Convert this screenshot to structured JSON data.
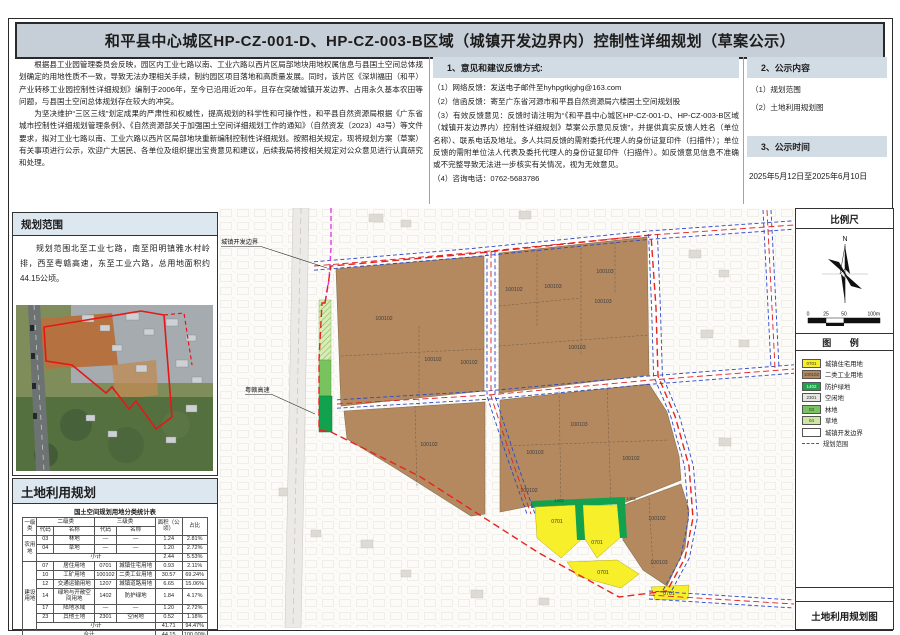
{
  "title": "和平县中心城区HP-CZ-001-D、HP-CZ-003-B区域（城镇开发边界内）控制性详细规划（草案公示）",
  "intro": {
    "p1": "根据县工业园管理委员会反映，园区内工业七路以南、工业六路以西片区局部地块用地权属信息与县国土空间总体规划确定的用地性质不一致，导致无法办理相关手续，制约园区项目落地和高质量发展。同时，该片区《深圳福田（和平）产业转移工业园控制性详细规划》编制于2006年，至今已沿用近20年，且存在突破城镇开发边界、占用永久基本农田等问题，与县国土空间总体规划存在较大的冲突。",
    "p2": "为坚决维护“三区三线”划定成果的严肃性和权威性，提高规划的科学性和可操作性，和平县自然资源局根据《广东省城市控制性详细规划管理条例》、《自然资源部关于加强国土空间详细规划工作的通知》（自然资发〔2023〕43号）等文件要求，拟对工业七路以南、工业六路以西片区局部地块重新编制控制性详细规划。按照相关规定，现将规划方案（草案）有关事项进行公示，欢迎广大居民、各单位及组织提出宝贵意见和建议，后续我局将按相关规定对公众意见进行认真研究和处理。"
  },
  "feedback": {
    "heading": "1、意见和建议反馈方式:",
    "item1": "（1）网络反馈：发送电子邮件至hyhpgtkjghg@163.com",
    "item2": "（2）信函反馈：寄至广东省河源市和平县自然资源局六楼国土空间规划股",
    "item3": "（3）有效反馈意见：反馈时请注明为“《和平县中心城区HP-CZ-001-D、HP-CZ-003-B区域（城镇开发边界内）控制性详细规划》草案公示意见反馈”，并提供真实反馈人姓名（单位名称）、联系电话及地址。多人共同反馈的需附委托代理人的身份证复印件（扫描件）；单位反馈的需附单位法人代表及委托代理人的身份证复印件（扫描件）。如反馈意见信息不准确或不完整导致无法进一步核实有关情况，视为无效意见。",
    "item4": "（4）咨询电话：0762-5683786"
  },
  "content_section": {
    "heading": "2、公示内容",
    "item1": "（1）规划范围",
    "item2": "（2）土地利用规划图"
  },
  "time_section": {
    "heading": "3、公示时间",
    "text": "2025年5月12日至2025年6月10日"
  },
  "scope_panel": {
    "heading": "规划范围",
    "text": "规划范围北至工业七路，南至阳明镇雅水村岭排，西至粤赣高速，东至工业六路，总用地面积约44.15公顷。"
  },
  "landuse_panel": {
    "heading": "土地利用规划",
    "table": {
      "title": "国土空间规划用地分类统计表",
      "headers": {
        "l1": "一级类",
        "l2": "二级类",
        "l3": "三级类",
        "code": "代码",
        "name": "名称",
        "area": "面积（公顷）",
        "pct": "占比"
      },
      "r1": {
        "cat": "农用地",
        "c2": "03",
        "n2": "林地",
        "c3": "—",
        "n3": "—",
        "area": "1.24",
        "pct": "2.81%"
      },
      "r2": {
        "c2": "04",
        "n2": "草地",
        "c3": "—",
        "n3": "—",
        "area": "1.20",
        "pct": "2.72%"
      },
      "r3": {
        "label": "小计",
        "area": "2.44",
        "pct": "5.53%"
      },
      "r4": {
        "cat": "建设用地",
        "c2": "07",
        "n2": "居住用地",
        "c3": "0701",
        "n3": "城镇住宅用地",
        "area": "0.93",
        "pct": "2.11%"
      },
      "r5": {
        "c2": "10",
        "n2": "工矿用地",
        "c3": "100102",
        "n3": "二类工业用地",
        "area": "30.57",
        "pct": "69.24%"
      },
      "r6": {
        "c2": "12",
        "n2": "交通运输用地",
        "c3": "1207",
        "n3": "城镇道路用地",
        "area": "6.65",
        "pct": "15.06%"
      },
      "r7": {
        "c2": "14",
        "n2": "绿地与开敞空间用地",
        "c3": "1402",
        "n3": "防护绿地",
        "area": "1.84",
        "pct": "4.17%"
      },
      "r8": {
        "c2": "17",
        "n2": "陆地水域",
        "c3": "—",
        "n3": "—",
        "area": "1.20",
        "pct": "2.72%"
      },
      "r9": {
        "c2": "23",
        "n2": "其他土地",
        "c3": "2301",
        "n3": "空闲地",
        "area": "0.52",
        "pct": "1.18%"
      },
      "r10": {
        "label": "小计",
        "area": "41.71",
        "pct": "94.47%"
      },
      "r11": {
        "label": "合计",
        "area": "44.15",
        "pct": "100.00%"
      }
    }
  },
  "map": {
    "annotations": {
      "boundary": "城镇开发边界",
      "highway": "粤赣高速"
    },
    "labels": [
      "100102",
      "100102",
      "100102",
      "100102",
      "100103",
      "100103",
      "100103",
      "100103",
      "100103",
      "100102",
      "100103",
      "100102",
      "100102",
      "100102",
      "100103",
      "0701",
      "0701",
      "0701",
      "0701",
      "1402",
      "1402"
    ]
  },
  "sidebar": {
    "scale_title": "比例尺",
    "north": "N",
    "scale_ticks": [
      "0",
      "25",
      "50",
      "100m"
    ],
    "legend_title": "图 例",
    "legend": [
      {
        "code": "0701",
        "label": "城镇住宅用地",
        "color": "#f7ef2a"
      },
      {
        "code": "100102",
        "label": "二类工业用地",
        "color": "#b5895f"
      },
      {
        "code": "1402",
        "label": "防护绿地",
        "color": "#1fa24a"
      },
      {
        "code": "2301",
        "label": "空闲地",
        "color": "#e7e7e2"
      },
      {
        "code": "03",
        "label": "林地",
        "color": "#79c35e"
      },
      {
        "code": "04",
        "label": "草地",
        "color": "#cfe6a0"
      },
      {
        "code": "",
        "label": "城镇开发边界",
        "color": "#ffffff"
      },
      {
        "code": "",
        "label": "规划范围",
        "color": "dash"
      }
    ],
    "caption": "土地利用规划图"
  },
  "colors": {
    "title_bg": "#c6ced7",
    "section_bg": "#d2dce5",
    "panel_head_bg": "#dde7f0",
    "industrial": "#b5895f",
    "residential": "#f7ef2a",
    "protect_green": "#1fa24a",
    "road_blue": "#2a49c8",
    "boundary_red": "#e8231e",
    "dev_boundary_magenta": "#e33ae3"
  }
}
